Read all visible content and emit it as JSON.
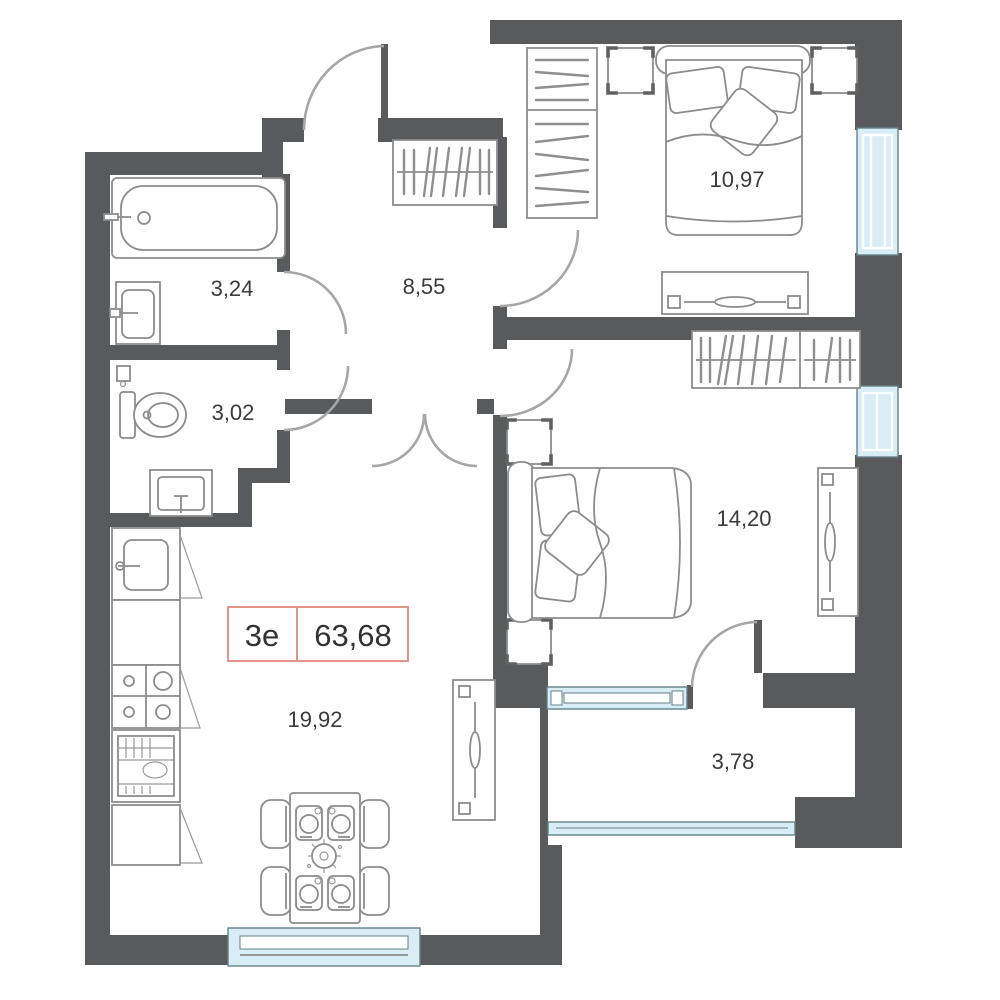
{
  "plan": {
    "title": "apartment-floor-plan",
    "unit": {
      "type_label": "3е",
      "total_area": "63,68"
    },
    "rooms": [
      {
        "id": "bathroom",
        "area": "3,24"
      },
      {
        "id": "wc",
        "area": "3,02"
      },
      {
        "id": "hallway",
        "area": "8,55"
      },
      {
        "id": "bedroom-1",
        "area": "10,97"
      },
      {
        "id": "bedroom-2",
        "area": "14,20"
      },
      {
        "id": "kitchen-living-room",
        "area": "19,92"
      },
      {
        "id": "balcony",
        "area": "3,78"
      }
    ],
    "colors": {
      "wall": "#595a5c",
      "window_fill": "#d9edf6",
      "window_stroke": "#64808a",
      "door_arc": "#a6a6a6",
      "unit_box_border": "#e2938c",
      "label_text": "#3b3b3b"
    }
  }
}
